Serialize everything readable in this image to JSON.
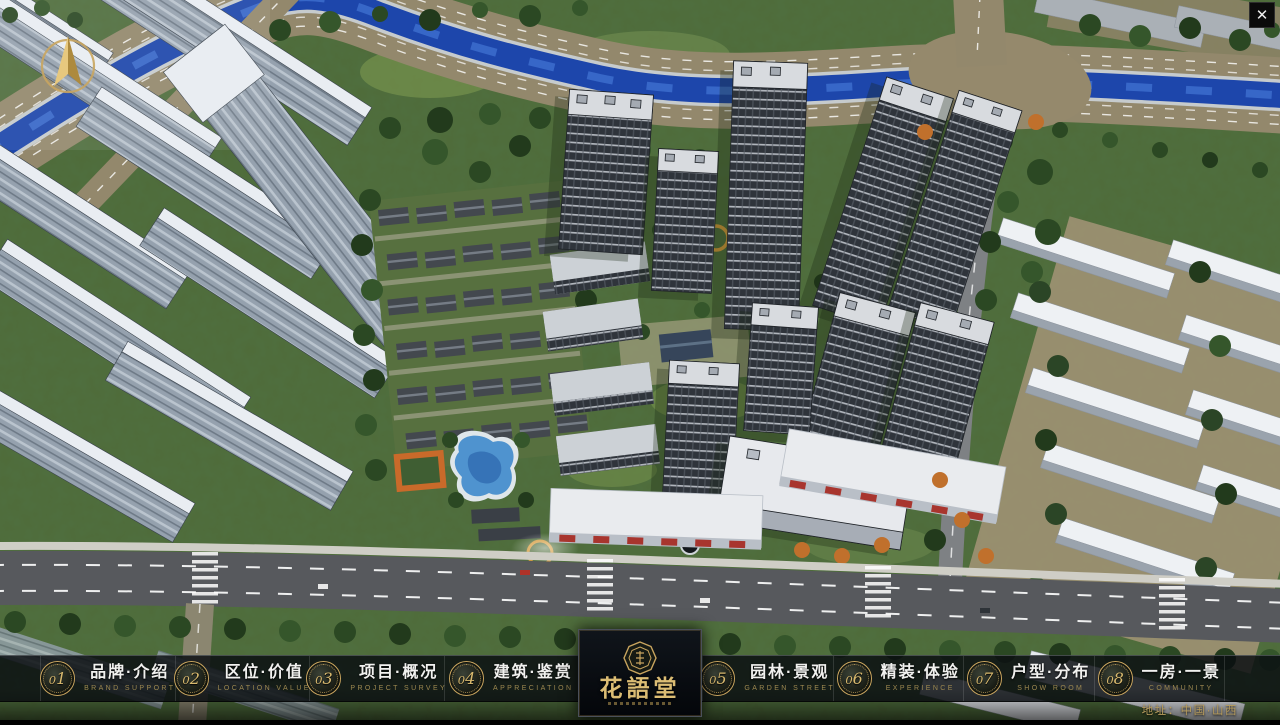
{
  "titlebar": {
    "close_glyph": "✕"
  },
  "icons": {
    "compass": "compass-north-needle",
    "close": "close-x",
    "logo_seal": "octagonal-seal-emblem"
  },
  "logo": {
    "name": "花語堂"
  },
  "nav": {
    "items": [
      {
        "num": "01",
        "title": "品牌·介绍",
        "subtitle": "BRAND SUPPORT"
      },
      {
        "num": "02",
        "title": "区位·价值",
        "subtitle": "LOCATION VALUE"
      },
      {
        "num": "03",
        "title": "项目·概况",
        "subtitle": "PROJECT SURVEY"
      },
      {
        "num": "04",
        "title": "建筑·鉴赏",
        "subtitle": "APPRECIATION"
      },
      {
        "num": "05",
        "title": "园林·景观",
        "subtitle": "GARDEN STREET"
      },
      {
        "num": "06",
        "title": "精装·体验",
        "subtitle": "EXPERIENCE"
      },
      {
        "num": "07",
        "title": "户型·分布",
        "subtitle": "SHOW ROOM"
      },
      {
        "num": "08",
        "title": "一房·一景",
        "subtitle": "COMMUNITY"
      }
    ]
  },
  "footer": {
    "address": "地址：中国·山西"
  },
  "colors": {
    "accent_gold": "#c9a55f",
    "bar_background": "rgba(9,13,17,0.84)",
    "title_text": "#f1f1ef",
    "subtitle_text": "#9d8850",
    "river_blue": "#1d46ab",
    "address_gold": "#b89d5e"
  }
}
